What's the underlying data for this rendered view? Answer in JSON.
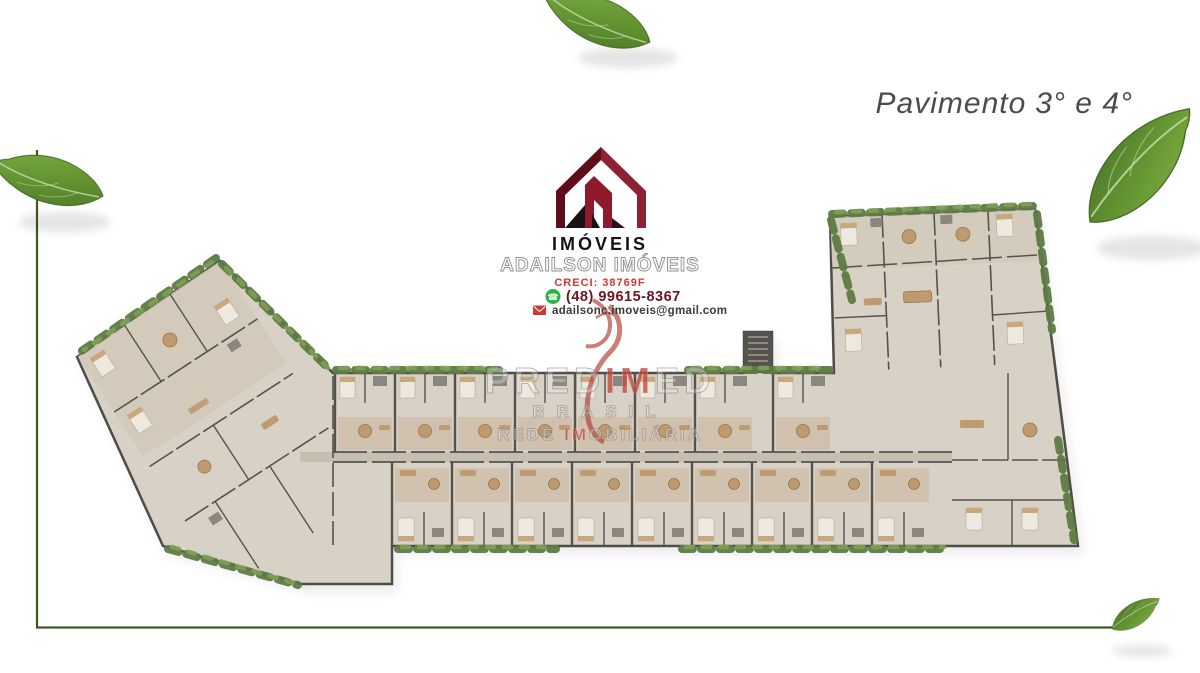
{
  "title": {
    "prefix": "Pavimento",
    "floors": "3° e 4°"
  },
  "logo": {
    "label": "IMÓVEIS",
    "name": "ADAILSON IMÓVEIS",
    "creci": "CRECI: 38769F",
    "phone": "(48) 99615-8367",
    "email": "adailsonc.imoveis@gmail.com"
  },
  "watermark": {
    "brand_pre": "PRED",
    "brand_accent": "IM",
    "brand_post": "ED",
    "line2": "BRASIL",
    "line3_pre": "REDE ",
    "line3_accent": "IM",
    "line3_post": "OBILIÁRIA"
  },
  "colors": {
    "brand_maroon": "#7d1424",
    "brand_maroon_dark": "#5f0d1b",
    "creci_red": "#cf3a30",
    "whatsapp_green": "#2ab540",
    "watermark_red": "#c2473e",
    "leaf_green": "#6a9a39",
    "frame_green": "#3c5a22",
    "plan_floor": "#d8d1c5",
    "plan_wall": "#4e4c48",
    "plan_hedge": "#5d7a43",
    "plan_wood": "#bd9a6f",
    "title_gray": "#4b4b4b"
  }
}
